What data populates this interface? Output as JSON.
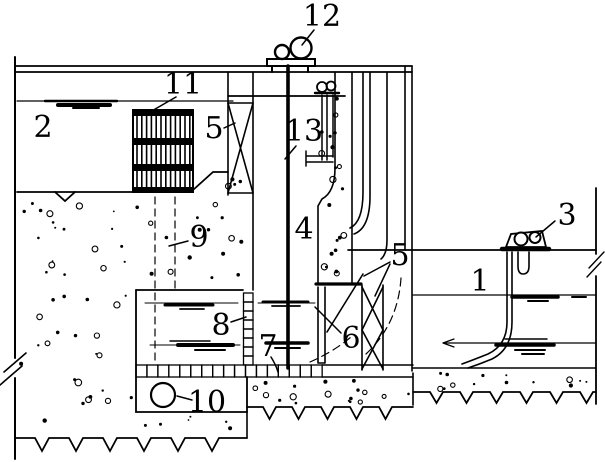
{
  "figure": {
    "background": "#ffffff",
    "ink": "#000000",
    "callouts": [
      {
        "id": "callout-12",
        "text": "12",
        "x": 322,
        "y": 26,
        "leader": "M314,30 L302,45"
      },
      {
        "id": "callout-11",
        "text": "11",
        "x": 183,
        "y": 94,
        "leader": "M176,97 L150,112"
      },
      {
        "id": "callout-2",
        "text": "2",
        "x": 43,
        "y": 137,
        "leader": ""
      },
      {
        "id": "callout-5a",
        "text": "5",
        "x": 214,
        "y": 138,
        "leader": "M224,128 L235,123"
      },
      {
        "id": "callout-13",
        "text": "13",
        "x": 304,
        "y": 141,
        "leader": "M296,146 L285,159"
      },
      {
        "id": "callout-4",
        "text": "4",
        "x": 304,
        "y": 239,
        "leader": ""
      },
      {
        "id": "callout-9",
        "text": "9",
        "x": 199,
        "y": 247,
        "leader": "M188,241 L169,246"
      },
      {
        "id": "callout-3",
        "text": "3",
        "x": 567,
        "y": 225,
        "leader": "M555,221 L536,237"
      },
      {
        "id": "callout-1",
        "text": "1",
        "x": 480,
        "y": 291,
        "leader": ""
      },
      {
        "id": "callout-5b",
        "text": "5",
        "x": 400,
        "y": 265,
        "leader": "M390,262 L364,276 M390,264 L375,296"
      },
      {
        "id": "callout-6",
        "text": "6",
        "x": 351,
        "y": 348,
        "leader": "M341,333 Q327,319 315,307"
      },
      {
        "id": "callout-8",
        "text": "8",
        "x": 221,
        "y": 335,
        "leader": "M231,322 L246,317"
      },
      {
        "id": "callout-7",
        "text": "7",
        "x": 268,
        "y": 356,
        "leader": "M271,357 Q276,365 278,372"
      },
      {
        "id": "callout-10",
        "text": "10",
        "x": 207,
        "y": 412,
        "leader": "M192,400 L177,396"
      }
    ]
  }
}
